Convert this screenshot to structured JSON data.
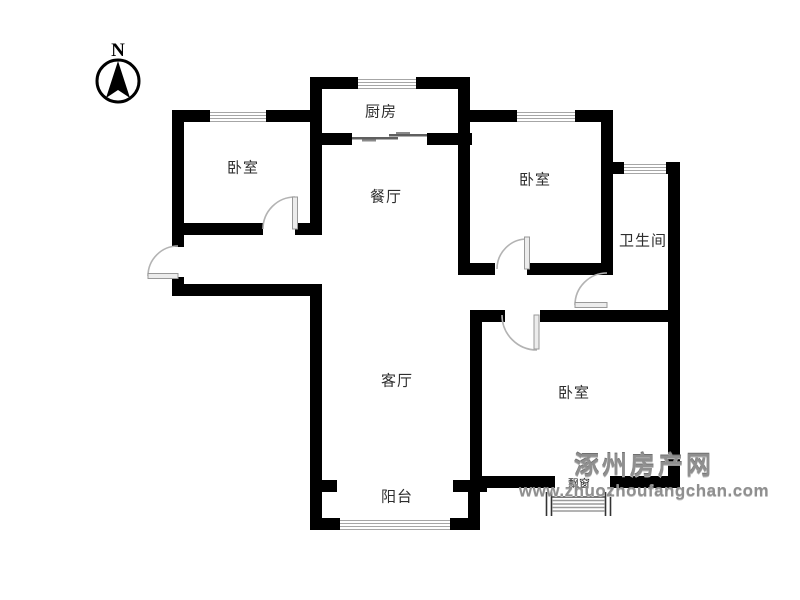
{
  "compass": {
    "north_label": "N"
  },
  "rooms": {
    "bedroom_nw": "卧室",
    "kitchen": "厨房",
    "dining_room": "餐厅",
    "bedroom_ne": "卧室",
    "bathroom": "卫生间",
    "living_room": "客厅",
    "bedroom_se": "卧室",
    "balcony": "阳台",
    "bay_window": "飘窗"
  },
  "watermark": {
    "site_name": "涿州房产网",
    "site_url": "www.zhuozhoufangchan.com"
  },
  "colors": {
    "wall": "#000000",
    "door_arc": "#b3b3b3",
    "window_stripe": "#a6a6a6",
    "room_label": "#2e2e2e",
    "watermark_gray": "#8f8f8f"
  }
}
